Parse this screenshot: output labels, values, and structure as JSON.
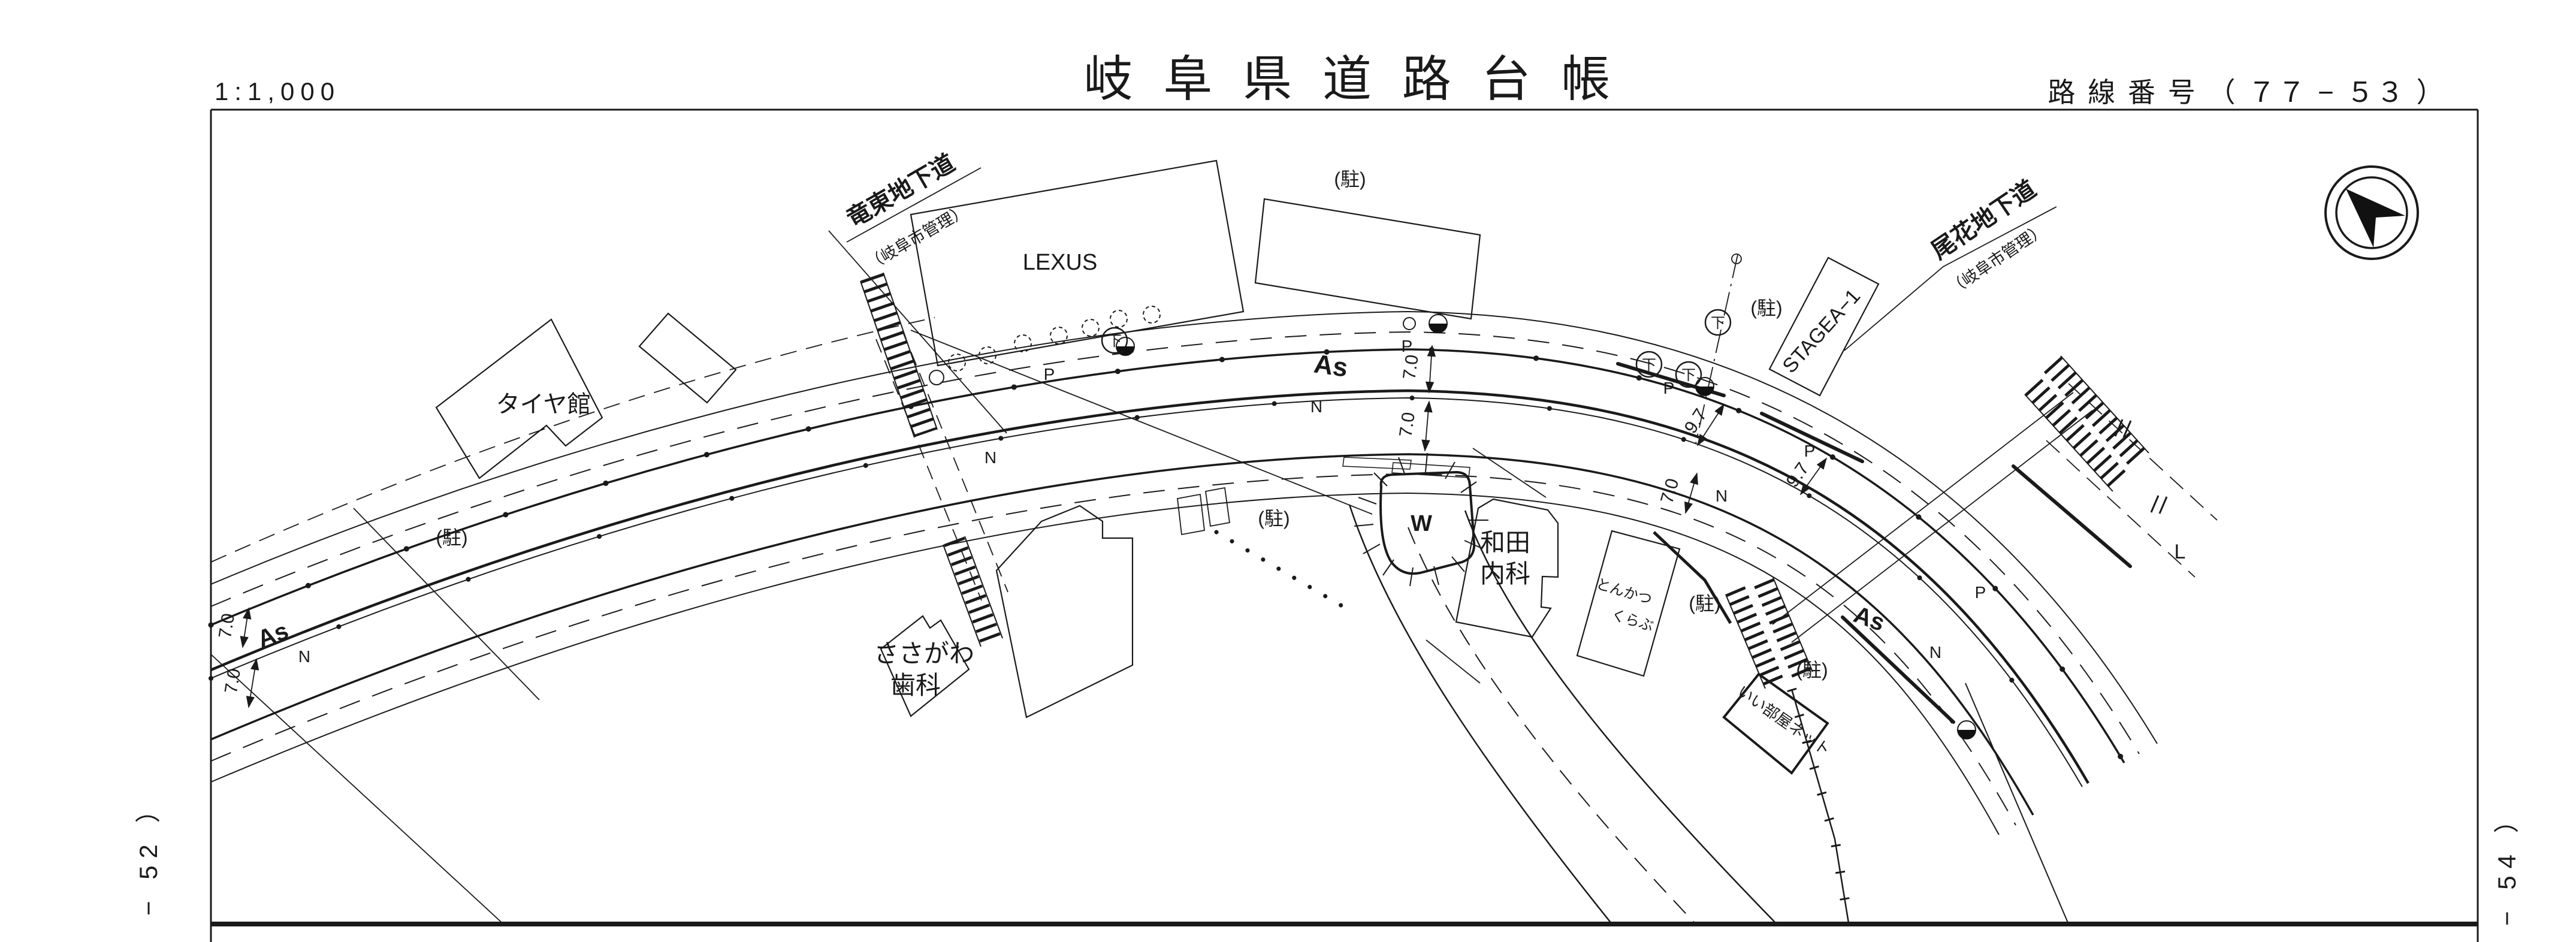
{
  "header": {
    "scale": "1:1,000",
    "title": "岐 阜 県 道 路 台 帳",
    "route": "路 線 番 号 （ ７７ − ５３ ）"
  },
  "sheet_refs": {
    "left": "− 52 ）",
    "right": "− 54 ）"
  },
  "map": {
    "underpass_left": {
      "name": "竜東地下道",
      "manager": "（岐阜市管理）"
    },
    "underpass_right": {
      "name": "尾花地下道",
      "manager": "（岐阜市管理）"
    },
    "buildings": {
      "tire": "タイヤ館",
      "lexus": "LEXUS",
      "sasagawa_line1": "ささがわ",
      "sasagawa_line2": "歯科",
      "wada_line1": "和田",
      "wada_line2": "内科",
      "tonkatsu_line1": "とんかつ",
      "tonkatsu_line2": "くらぶ",
      "stagea": "STAGEA−1",
      "iiheya": "いい部屋ネット"
    },
    "labels": {
      "parking": "(駐)",
      "asphalt": "As",
      "n_mark": "N",
      "pole": "P",
      "water": "W",
      "sewer": "下",
      "corner_mark": "L",
      "dim_7_0": "7.0",
      "dim_9_7": "9.7"
    }
  }
}
